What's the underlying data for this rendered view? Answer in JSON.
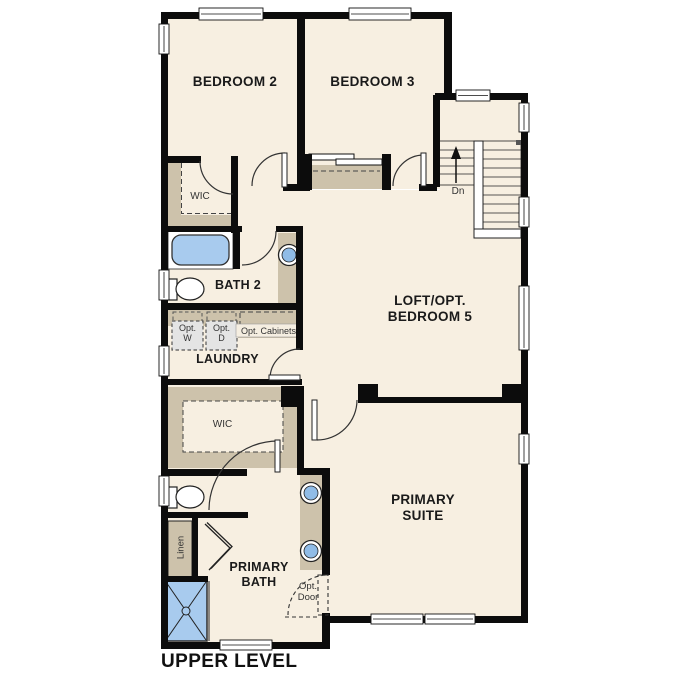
{
  "plan": {
    "title": "UPPER LEVEL",
    "rooms": {
      "bedroom2": "BEDROOM 2",
      "bedroom3": "BEDROOM 3",
      "wic_bedroom2": "WIC",
      "bath2": "BATH 2",
      "laundry": "LAUNDRY",
      "loft_line1": "LOFT/OPT.",
      "loft_line2": "BEDROOM 5",
      "primary_suite_line1": "PRIMARY",
      "primary_suite_line2": "SUITE",
      "primary_bath_line1": "PRIMARY",
      "primary_bath_line2": "BATH",
      "wic_primary": "WIC",
      "linen": "Linen"
    },
    "options": {
      "washer_line1": "Opt.",
      "washer_line2": "W",
      "dryer_line1": "Opt.",
      "dryer_line2": "D",
      "cabinets": "Opt. Cabinets",
      "door_line1": "Opt.",
      "door_line2": "Door"
    },
    "stairs": {
      "down_label": "Dn"
    },
    "colors": {
      "floor": "#f7efe1",
      "wall": "#0c0c0c",
      "casework": "#cdc2ab",
      "fixture_blue": "#a8cbee",
      "appliance_gray": "#e4e4e4"
    }
  }
}
